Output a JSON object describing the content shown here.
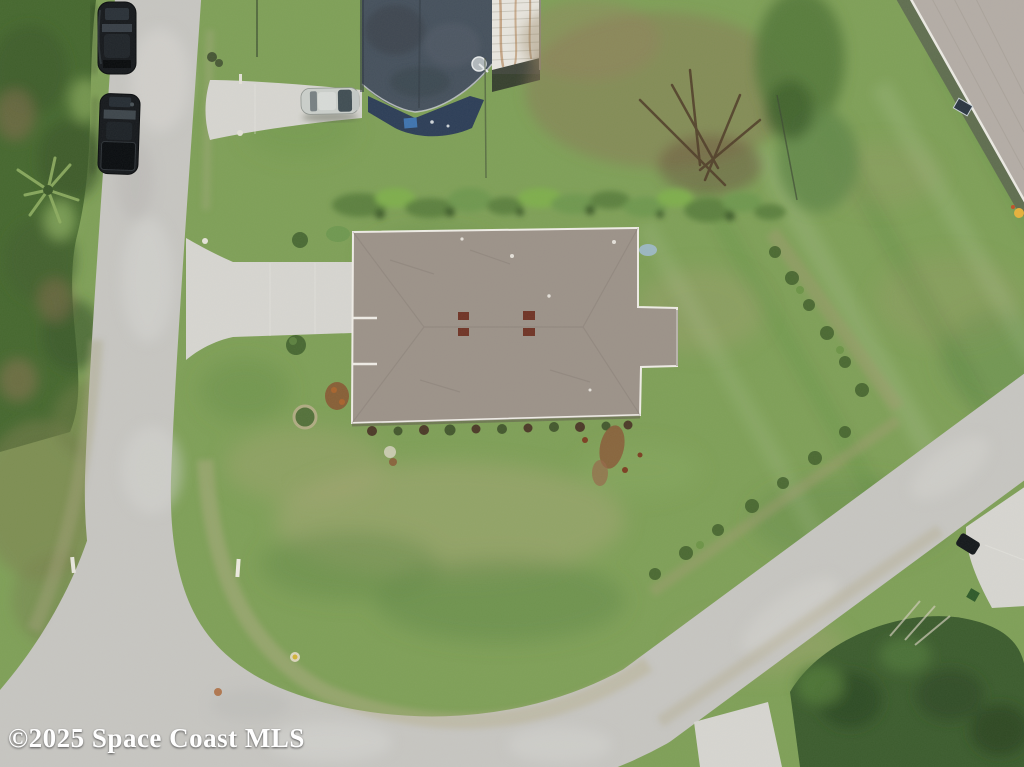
{
  "watermark": {
    "text": "©2025 Space Coast MLS"
  },
  "boundary": {
    "color": "#df2402",
    "stroke_width": 6
  },
  "palette": {
    "grass_base": "#7fa058",
    "grass_dark": "#5e8544",
    "grass_light": "#98b56c",
    "grass_dry": "#b2aa80",
    "vegetation_dark": "#46682f",
    "road": "#c7c6c2",
    "road_light": "#d8d7d3",
    "concrete": "#d7d6d1",
    "roof_main": "#9c9289",
    "roof_fascia": "#efece6",
    "roof_vent": "#703426",
    "neighbor_roof_dark": "#46515d",
    "neighbor_roof_navy": "#2d3e58",
    "carport_white": "#e9e6df",
    "rust": "#aa7342",
    "neighbor_roof_light": "#b4ada6",
    "wall_shadow": "#5c6750",
    "car_black": "#16191d",
    "car_silver": "#cbcfcb",
    "tree_canopy": "#3c5c2e",
    "dirt_brown": "#8b7556",
    "watermark_white": "#ffffff"
  }
}
